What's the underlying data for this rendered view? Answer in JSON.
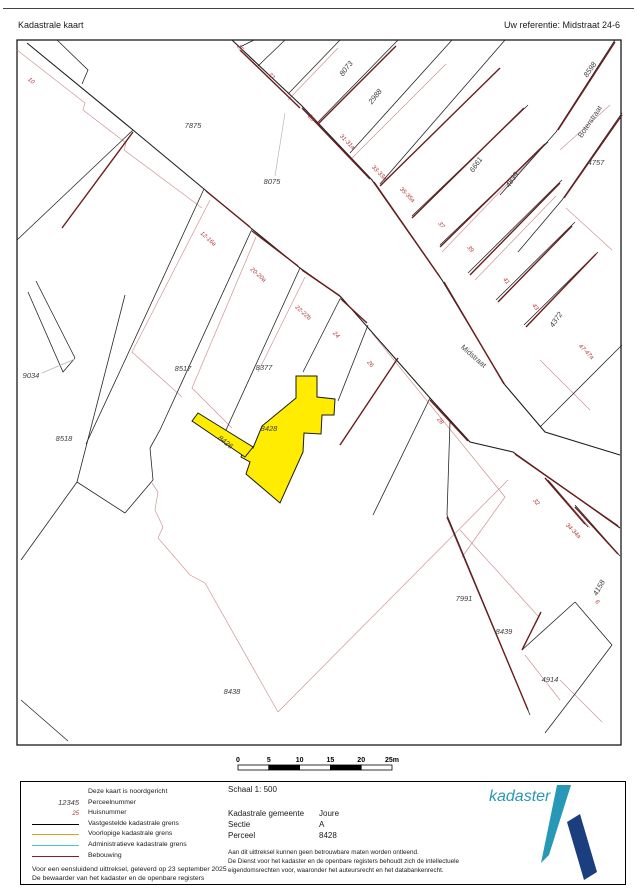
{
  "header": {
    "title": "Kadastrale kaart",
    "reference": "Uw referentie: Midstraat 24-6"
  },
  "map": {
    "highlight_color": "#ffec00",
    "parcel_labels": [
      {
        "t": "7875",
        "x": 193,
        "y": 128,
        "r": 0
      },
      {
        "t": "8075",
        "x": 272,
        "y": 184,
        "r": 0
      },
      {
        "t": "8073",
        "x": 348,
        "y": 70,
        "r": -52
      },
      {
        "t": "2988",
        "x": 377,
        "y": 98,
        "r": -52
      },
      {
        "t": "6661",
        "x": 478,
        "y": 166,
        "r": -55
      },
      {
        "t": "4839",
        "x": 514,
        "y": 181,
        "r": -55
      },
      {
        "t": "8598",
        "x": 592,
        "y": 71,
        "r": -55
      },
      {
        "t": "4757",
        "x": 596,
        "y": 165,
        "r": 0
      },
      {
        "t": "4372",
        "x": 558,
        "y": 321,
        "r": -55
      },
      {
        "t": "9034",
        "x": 31,
        "y": 378,
        "r": 0
      },
      {
        "t": "8517",
        "x": 183,
        "y": 371,
        "r": 0
      },
      {
        "t": "8377",
        "x": 264,
        "y": 370,
        "r": 0
      },
      {
        "t": "8428",
        "x": 269,
        "y": 431,
        "r": 0
      },
      {
        "t": "8426",
        "x": 224,
        "y": 444,
        "r": 38
      },
      {
        "t": "8518",
        "x": 64,
        "y": 441,
        "r": 0
      },
      {
        "t": "8438",
        "x": 232,
        "y": 694,
        "r": 0
      },
      {
        "t": "7991",
        "x": 464,
        "y": 601,
        "r": 0
      },
      {
        "t": "8439",
        "x": 504,
        "y": 634,
        "r": 0
      },
      {
        "t": "4914",
        "x": 550,
        "y": 682,
        "r": 0
      },
      {
        "t": "4158",
        "x": 601,
        "y": 589,
        "r": -60
      }
    ],
    "house_numbers": [
      {
        "t": "10",
        "x": 30,
        "y": 82,
        "r": 42
      },
      {
        "t": "25",
        "x": 239,
        "y": 49,
        "r": 50
      },
      {
        "t": "27",
        "x": 270,
        "y": 77,
        "r": 50
      },
      {
        "t": "29",
        "x": 310,
        "y": 119,
        "r": 50
      },
      {
        "t": "31-31a",
        "x": 346,
        "y": 143,
        "r": 45
      },
      {
        "t": "33-33a",
        "x": 378,
        "y": 174,
        "r": 45
      },
      {
        "t": "35-35a",
        "x": 406,
        "y": 196,
        "r": 45
      },
      {
        "t": "37",
        "x": 440,
        "y": 226,
        "r": 50
      },
      {
        "t": "39",
        "x": 469,
        "y": 250,
        "r": 50
      },
      {
        "t": "41",
        "x": 505,
        "y": 282,
        "r": 50
      },
      {
        "t": "43",
        "x": 534,
        "y": 308,
        "r": 50
      },
      {
        "t": "47-47a",
        "x": 585,
        "y": 353,
        "r": 45
      },
      {
        "t": "12-16a",
        "x": 207,
        "y": 240,
        "r": 42
      },
      {
        "t": "20-20a",
        "x": 257,
        "y": 276,
        "r": 42
      },
      {
        "t": "22-22b",
        "x": 302,
        "y": 314,
        "r": 42
      },
      {
        "t": "24",
        "x": 335,
        "y": 336,
        "r": 45
      },
      {
        "t": "26",
        "x": 369,
        "y": 365,
        "r": 50
      },
      {
        "t": "28",
        "x": 439,
        "y": 422,
        "r": 50
      },
      {
        "t": "32",
        "x": 535,
        "y": 503,
        "r": 50
      },
      {
        "t": "34-34a",
        "x": 572,
        "y": 532,
        "r": 45
      },
      {
        "t": "6",
        "x": 596,
        "y": 603,
        "r": 50
      }
    ],
    "street_names": [
      {
        "t": "Midstraat",
        "x": 472,
        "y": 358,
        "r": 41
      },
      {
        "t": "Boterstraat",
        "x": 592,
        "y": 123,
        "r": -56
      }
    ]
  },
  "scalebar": {
    "ticks": [
      "0",
      "5",
      "10",
      "15",
      "20",
      "25m"
    ]
  },
  "legend": {
    "sample_parcel": "12345",
    "sample_house": "25",
    "items": [
      {
        "label": "Deze kaart is noordgericht",
        "swatch": "none"
      },
      {
        "label": "Perceelnummer",
        "swatch": "parcel"
      },
      {
        "label": "Huisnummer",
        "swatch": "house"
      },
      {
        "label": "Vastgestelde kadastrale grens",
        "swatch": "#000000"
      },
      {
        "label": "Voorlopige kadastrale grens",
        "swatch": "#d9a227"
      },
      {
        "label": "Administratieve kadastrale grens",
        "swatch": "#42c8dc"
      },
      {
        "label": "Bebouwing",
        "swatch": "#8a1f1f"
      }
    ],
    "footer_lines": [
      "Voor een eensluidend uittreksel, geleverd op 23 september 2025",
      "De bewaarder van het kadaster en de openbare registers"
    ],
    "info": {
      "schaal": "Schaal 1: 500",
      "rows": [
        {
          "label": "Kadastrale gemeente",
          "value": "Joure"
        },
        {
          "label": "Sectie",
          "value": "A"
        },
        {
          "label": "Perceel",
          "value": "8428"
        }
      ],
      "fine_print": [
        "Aan dit uittreksel kunnen geen betrouwbare maten worden ontleend.",
        "De Dienst voor het kadaster en de openbare registers behoudt zich de intellectuele",
        "eigendomsrechten voor, waaronder het auteursrecht en het databankenrecht."
      ]
    }
  },
  "logo": {
    "wordmark": "kadaster",
    "teal": "#2798b5",
    "navy": "#1b3f7e"
  }
}
